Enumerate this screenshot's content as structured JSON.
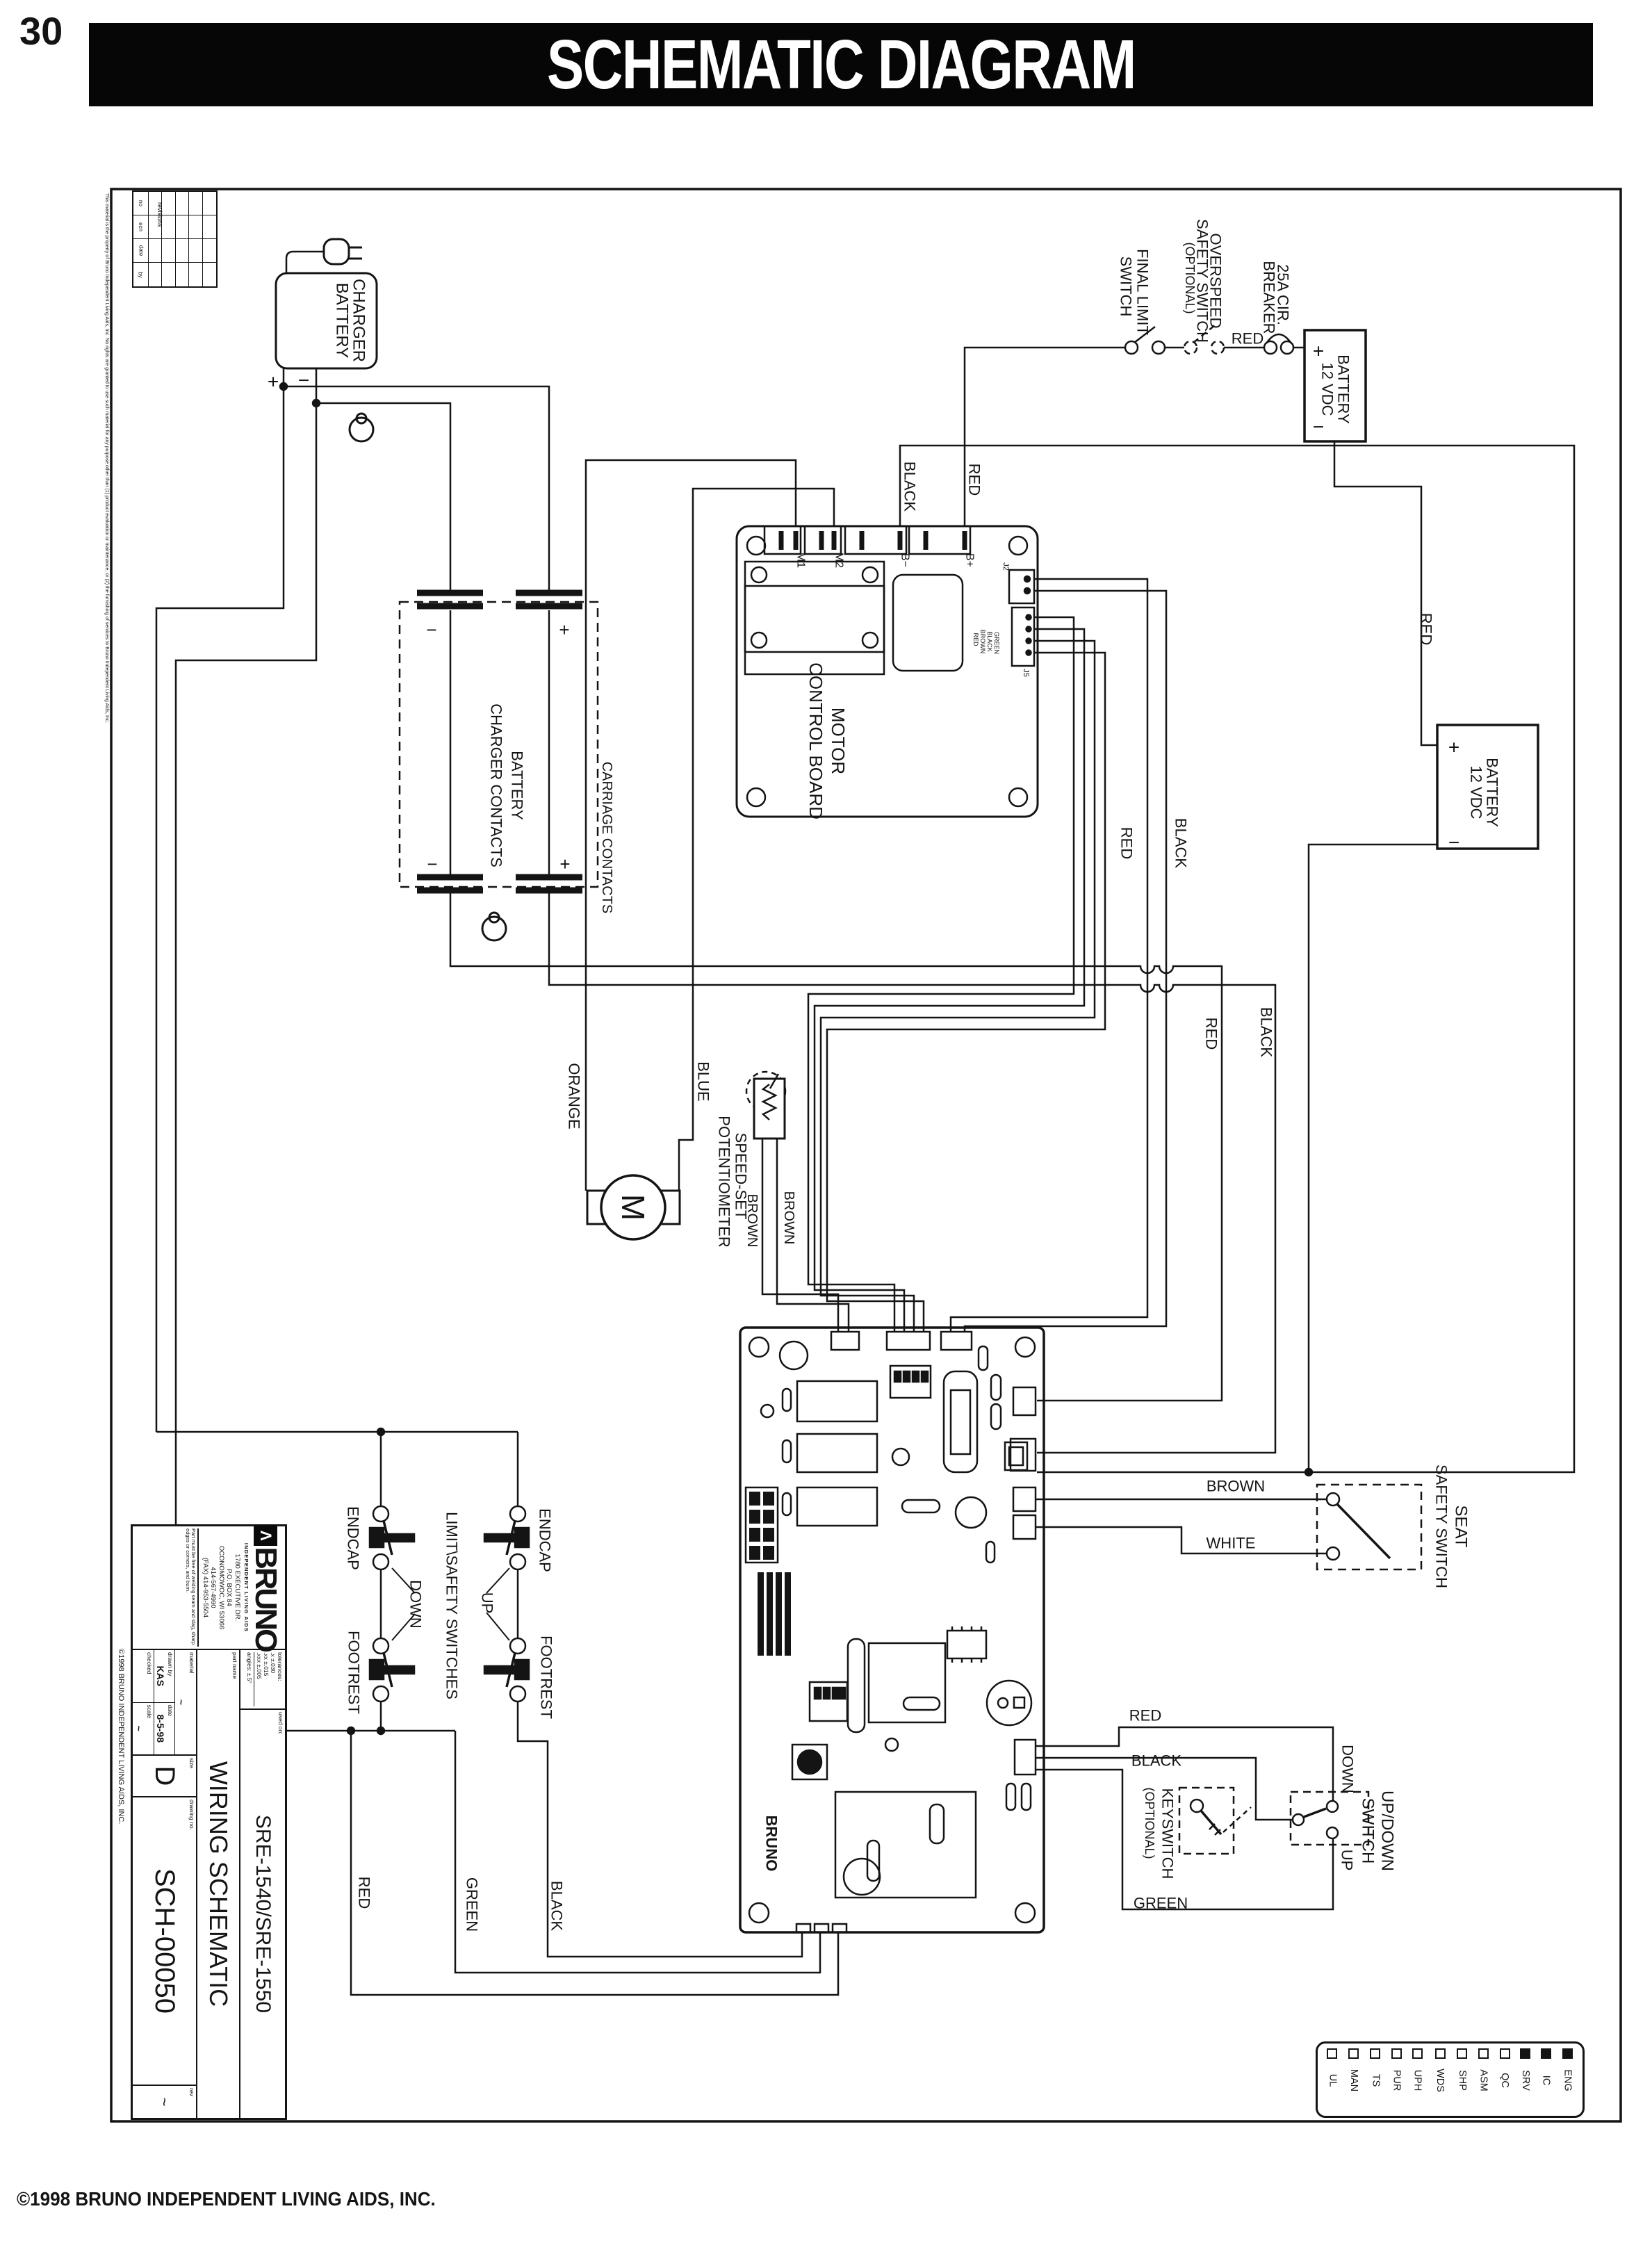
{
  "page": {
    "number": "30",
    "title": "SCHEMATIC DIAGRAM",
    "copyright": "©1998 BRUNO INDEPENDENT LIVING AIDS, INC."
  },
  "sheet": {
    "revisions": {
      "title": "revisions",
      "columns": [
        "no",
        "ecn",
        "date",
        "by"
      ]
    },
    "disclaimer": "This material is the property of Bruno Independent Living Aids, Inc.  No rights are granted to use such material for any purpose other than (1) product evaluation or maintenance, or (2) the furnishing of services to Bruno Independent Living Aids, Inc.",
    "side_copyright": "©1998 BRUNO INDEPENDENT LIVING AIDS, INC."
  },
  "charger": {
    "l1": "BATTERY",
    "l2": "CHARGER",
    "plus": "+",
    "minus": "−"
  },
  "contacts": {
    "l1": "BATTERY",
    "l2": "CHARGER CONTACTS",
    "carriage": "CARRIAGE CONTACTS",
    "top_minus": "−",
    "top_plus": "+",
    "bot_minus": "−",
    "bot_plus": "+"
  },
  "board": {
    "l1": "MOTOR",
    "l2": "CONTROL BOARD",
    "m1": "M1",
    "m2": "M2",
    "bminus": "B−",
    "bplus": "B+",
    "j2": "J2",
    "j5": "J5",
    "jw": [
      "RED",
      "BROWN",
      "BLACK",
      "GREEN"
    ]
  },
  "motor": {
    "m": "M"
  },
  "pot": {
    "l1": "SPEED-SET",
    "l2": "POTENTIOMETER",
    "w1": "BROWN",
    "w2": "BROWN"
  },
  "flsw": {
    "l1": "FINAL LIMIT",
    "l2": "SWITCH"
  },
  "ossw": {
    "l1": "OVERSPEED",
    "l2": "SAFETY SWITCH",
    "l3": "(OPTIONAL)"
  },
  "breaker": {
    "l1": "25A CIR.",
    "l2": "BREAKER",
    "red": "RED"
  },
  "bat1": {
    "l1": "12 VDC",
    "l2": "BATTERY",
    "plus": "+",
    "minus": "−",
    "red": "RED"
  },
  "bat2": {
    "l1": "12 VDC",
    "l2": "BATTERY",
    "plus": "+",
    "minus": "−"
  },
  "wires": {
    "red_bplus": "RED",
    "black_bminus": "BLACK",
    "red_mid": "RED",
    "black_mid": "BLACK",
    "red_low": "RED",
    "black_low": "BLACK",
    "orange": "ORANGE",
    "blue": "BLUE"
  },
  "seat": {
    "l1": "SEAT",
    "l2": "SAFETY SWITCH",
    "brown": "BROWN",
    "white": "WHITE"
  },
  "key": {
    "l1": "KEYSWITCH",
    "l2": "(OPTIONAL)"
  },
  "updown": {
    "l1": "UP/DOWN",
    "l2": "SWITCH",
    "down": "DOWN",
    "up": "UP",
    "red": "RED",
    "black": "BLACK",
    "green": "GREEN"
  },
  "limitsw": {
    "title": "LIMIT\\SAFETY SWITCHES",
    "endcap_l": "ENDCAP",
    "endcap_r": "ENDCAP",
    "footrest_l": "FOOTREST",
    "footrest_r": "FOOTREST",
    "down": "DOWN",
    "up": "UP",
    "red": "RED",
    "green": "GREEN",
    "black": "BLACK"
  },
  "pcb": {
    "brand": "BRUNO"
  },
  "title_block": {
    "company": "BRUNO",
    "company_sub": "INDEPENDENT LIVING AIDS",
    "address": [
      "1780 EXECUTIVE DR.",
      "P.O. BOX 84",
      "OCONOMOWOC, WI 53066",
      "414-567-4990",
      "(FAX) 414-953-5504"
    ],
    "note": "Part must be free of welding seam and slag, sharp edges or corners, and burn.",
    "tolerances": {
      "label": "tolerances:",
      "x": ".x ±.030",
      "xx": ".xx ±.015",
      "xxx": ".xxx ±.005",
      "angles": "angles: ±.5°"
    },
    "used_on": {
      "label": "used on:",
      "value": "SRE-1540/SRE-1550"
    },
    "part_name": {
      "label": "part name",
      "value": "WIRING SCHEMATIC"
    },
    "material": {
      "label": "material",
      "value": "~"
    },
    "drawn_by": {
      "label": "drawn by",
      "value": "KAS"
    },
    "date": {
      "label": "date",
      "value": "8-5-98"
    },
    "checked": {
      "label": "checked",
      "value": ""
    },
    "scale": {
      "label": "scale",
      "value": "~"
    },
    "size": {
      "label": "size",
      "value": "D"
    },
    "drawing_no": {
      "label": "drawing no.",
      "value": "SCH-00050"
    },
    "rev": {
      "label": "rev",
      "value": "~"
    }
  },
  "legend": {
    "items": [
      {
        "label": "ENG",
        "checked": true
      },
      {
        "label": "IC",
        "checked": true
      },
      {
        "label": "SRV",
        "checked": true
      },
      {
        "label": "QC",
        "checked": false
      },
      {
        "label": "ASM",
        "checked": false
      },
      {
        "label": "SHP",
        "checked": false
      },
      {
        "label": "WDS",
        "checked": false
      },
      {
        "label": "UPH",
        "checked": false
      },
      {
        "label": "PUR",
        "checked": false
      },
      {
        "label": "TS",
        "checked": false
      },
      {
        "label": "MAN",
        "checked": false
      },
      {
        "label": "UL",
        "checked": false
      }
    ]
  }
}
